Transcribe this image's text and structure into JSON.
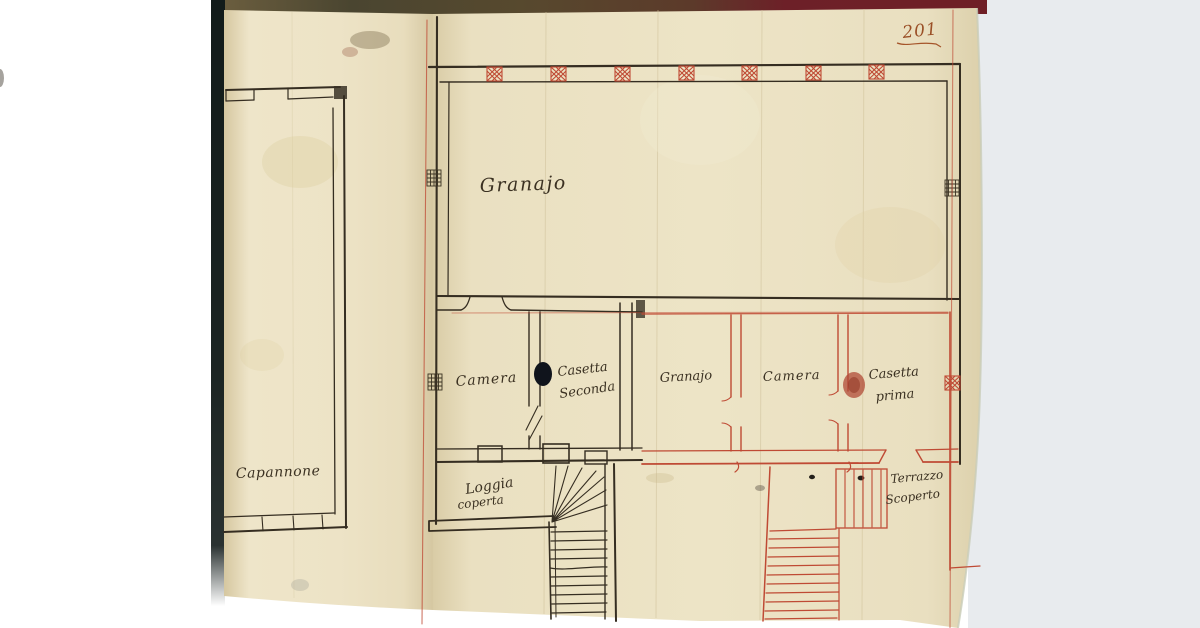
{
  "folio": {
    "page_number": "201"
  },
  "plan": {
    "rooms": {
      "granajo_hall": "Granajo",
      "camera_west": "Camera",
      "casetta_seconda": {
        "line1": "Casetta",
        "line2": "Seconda"
      },
      "granajo_small": "Granajo",
      "camera_east": "Camera",
      "casetta_prima": {
        "line1": "Casetta",
        "line2": "prima"
      },
      "capannone": "Capannone",
      "loggia_coperta": {
        "line1": "Loggia",
        "line2": "coperta"
      },
      "terrazzo_scoperto": {
        "line1": "Terrazzo",
        "line2": "Scoperto"
      }
    },
    "ink_colors": {
      "black_ink": "#352d21",
      "red_ink": "#bf4a34",
      "folio_ink": "#9a4f26",
      "paper": "#ece2c4"
    }
  }
}
